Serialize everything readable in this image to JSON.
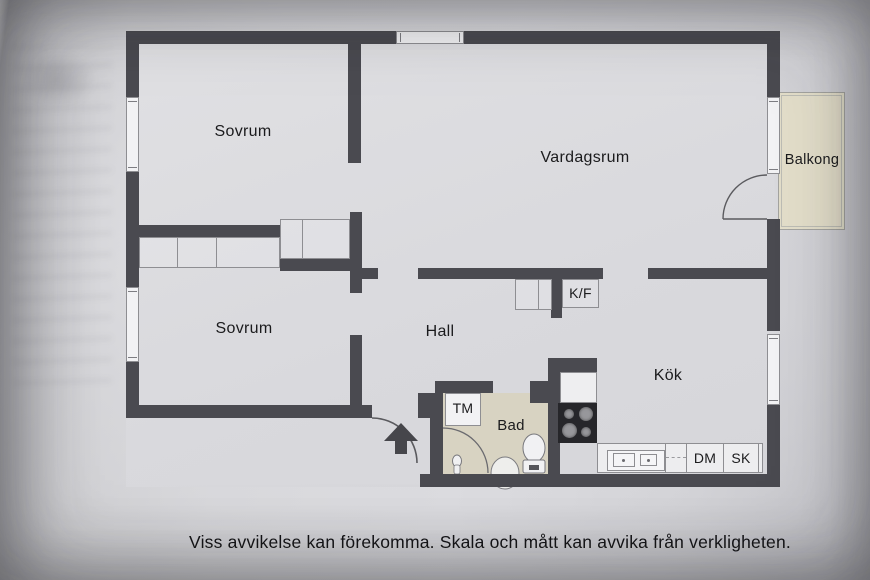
{
  "rooms": {
    "bedroom_top": "Sovrum",
    "bedroom_bottom": "Sovrum",
    "living_room": "Vardagsrum",
    "balcony": "Balkong",
    "hall": "Hall",
    "kitchen": "Kök",
    "bathroom": "Bad"
  },
  "units": {
    "fridge_freezer": "K/F",
    "washing_machine": "TM",
    "dishwasher": "DM",
    "cabinet": "SK"
  },
  "caption": {
    "text": "Viss avvikelse kan förekomma. Skala och mått kan avvika från verkligheten."
  },
  "colors": {
    "wall": "#4a4a50",
    "floor": "#dcdcdf",
    "bath_floor": "#d8d3c2",
    "balcony_floor": "#e2ddc9",
    "outline": "#8e8e92",
    "box_white": "#f2f2f4",
    "stove": "#26262a",
    "burner": "#97979b",
    "text": "#1b1b1d"
  }
}
